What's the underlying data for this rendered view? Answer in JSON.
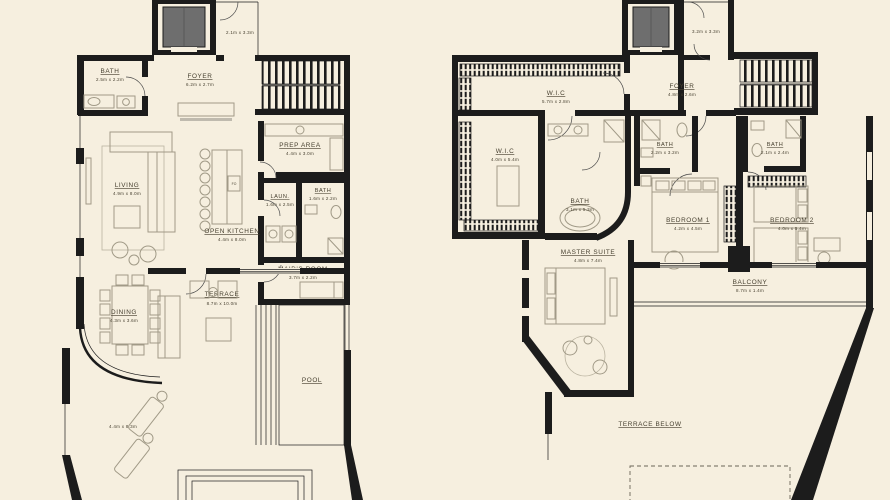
{
  "colors": {
    "background": "#f6efdf",
    "wall": "#1c1c1c",
    "furniture_line": "#a19a87",
    "label_text": "#474030",
    "elevator_car": "#6e6e6e"
  },
  "lower": {
    "bath": {
      "label": "BATH",
      "dims": "2.5m x 2.2m"
    },
    "foyer": {
      "label": "FOYER",
      "dims": "6.2m x 2.7m"
    },
    "stair_landing": {
      "dims": "2.1m x 3.3m"
    },
    "living": {
      "label": "LIVING",
      "dims": "4.9m x 8.0m"
    },
    "open_kitchen": {
      "label": "OPEN KITCHEN",
      "dims": "4.4m x 8.0m",
      "appliance": "FO"
    },
    "prep_area": {
      "label": "PREP AREA",
      "dims": "4.4m x 3.0m"
    },
    "laundry": {
      "label": "LAUN.",
      "dims": "1.6m x 2.5m"
    },
    "bath2": {
      "label": "BATH",
      "dims": "1.6m x 2.2m"
    },
    "maids_room": {
      "label": "MAID'S ROOM",
      "dims": "3.7m x 2.2m"
    },
    "dining": {
      "label": "DINING",
      "dims": "4.3m x 3.6m"
    },
    "terrace": {
      "label": "TERRACE",
      "dims": "8.7m x 10.0m"
    },
    "pool": {
      "label": "POOL"
    },
    "side_terrace": {
      "dims": "4.4m x 8.3m"
    }
  },
  "upper": {
    "wic1": {
      "label": "W.I.C",
      "dims": "5.7m x 2.8m"
    },
    "foyer": {
      "label": "FOYER",
      "dims": "4.8m x 2.6m"
    },
    "stair_room": {
      "dims": "3.2m x 3.3m"
    },
    "wic2": {
      "label": "W.I.C",
      "dims": "4.0m x 5.4m"
    },
    "master_bath": {
      "label": "BATH",
      "dims": "3.1m x 5.3m"
    },
    "bath_bed1": {
      "label": "BATH",
      "dims": "2.2m x 3.2m"
    },
    "bath_bed2": {
      "label": "BATH",
      "dims": "2.1m x 2.4m"
    },
    "bedroom1": {
      "label": "BEDROOM 1",
      "dims": "4.2m x 4.5m"
    },
    "bedroom2": {
      "label": "BEDROOM 2",
      "dims": "4.0m x 5.4m"
    },
    "master_suite": {
      "label": "MASTER SUITE",
      "dims": "4.8m x 7.4m"
    },
    "balcony": {
      "label": "BALCONY",
      "dims": "8.7m x 1.4m"
    },
    "terrace_below": {
      "label": "TERRACE BELOW"
    }
  }
}
